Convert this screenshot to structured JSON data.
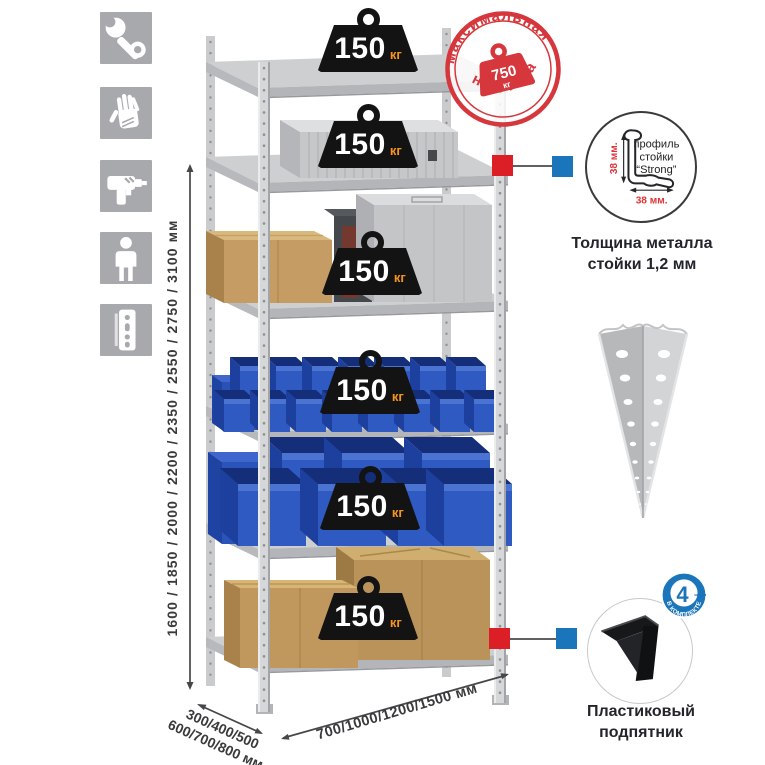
{
  "icons": [
    {
      "name": "wrench-icon"
    },
    {
      "name": "gloves-icon"
    },
    {
      "name": "drill-icon"
    },
    {
      "name": "person-icon"
    },
    {
      "name": "shelf-post-icon"
    }
  ],
  "dimensions": {
    "height": "1600 / 1850 / 2000 / 2200 / 2350 / 2550 / 2750 / 3100 мм",
    "depth_line1": "300/400/500",
    "depth_line2": "600/700/800 мм",
    "width": "700/1000/1200/1500 мм"
  },
  "badges": [
    {
      "value": "150",
      "unit": "кг"
    },
    {
      "value": "150",
      "unit": "кг"
    },
    {
      "value": "150",
      "unit": "кг"
    },
    {
      "value": "150",
      "unit": "кг"
    },
    {
      "value": "150",
      "unit": "кг"
    },
    {
      "value": "150",
      "unit": "кг"
    }
  ],
  "stamp": {
    "arc_top": "максимальная",
    "arc_bottom": "нагрузка",
    "weight_value": "750",
    "weight_unit": "кг"
  },
  "profile": {
    "label_line1": "профиль",
    "label_line2": "стойки",
    "label_line3": "“Strong”",
    "dim_v": "38 мм.",
    "dim_h": "38 мм.",
    "caption_line1": "Толщина металла",
    "caption_line2": "стойки 1,2 мм"
  },
  "foot": {
    "badge_value": "4",
    "badge_units": "штуки",
    "badge_arc": "В КОМПЛЕКТЕ",
    "caption_line1": "Пластиковый",
    "caption_line2": "подпятник"
  },
  "colors": {
    "stamp_red": "#d5373d",
    "marker_red": "#dc1f26",
    "marker_blue": "#1b75bb",
    "badge_black": "#131313",
    "badge_unit_orange": "#f7941d",
    "bin_blue": "#2e5ac2",
    "metal_gray": "#cdcfd1",
    "icon_gray": "#a7a9ac"
  }
}
